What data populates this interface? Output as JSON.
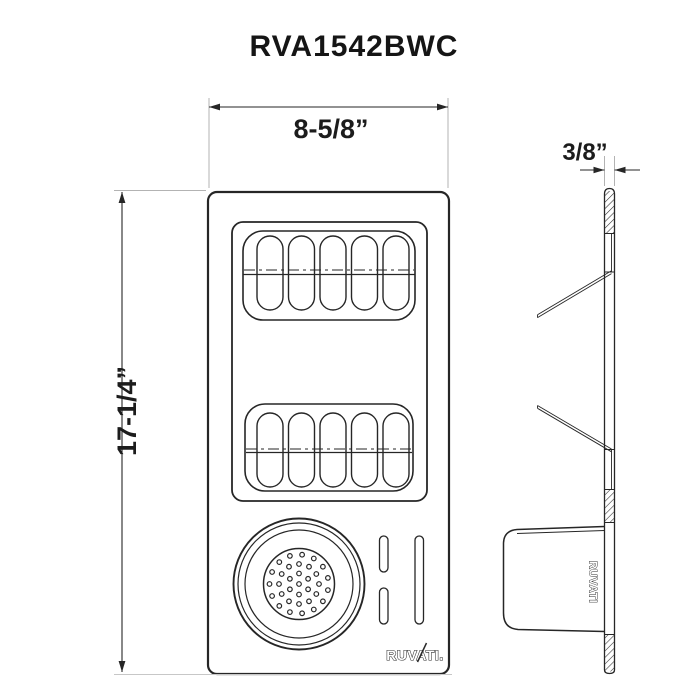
{
  "title": "RVA1542BWC",
  "dimensions": {
    "width": "8-5/8”",
    "height": "17-1/4”",
    "thickness": "3/8”"
  },
  "branding": {
    "front_logo": "RUVATI.",
    "side_logo": "RUVATI"
  },
  "colors": {
    "line": "#262626",
    "extension_line": "#b3b3b3"
  }
}
